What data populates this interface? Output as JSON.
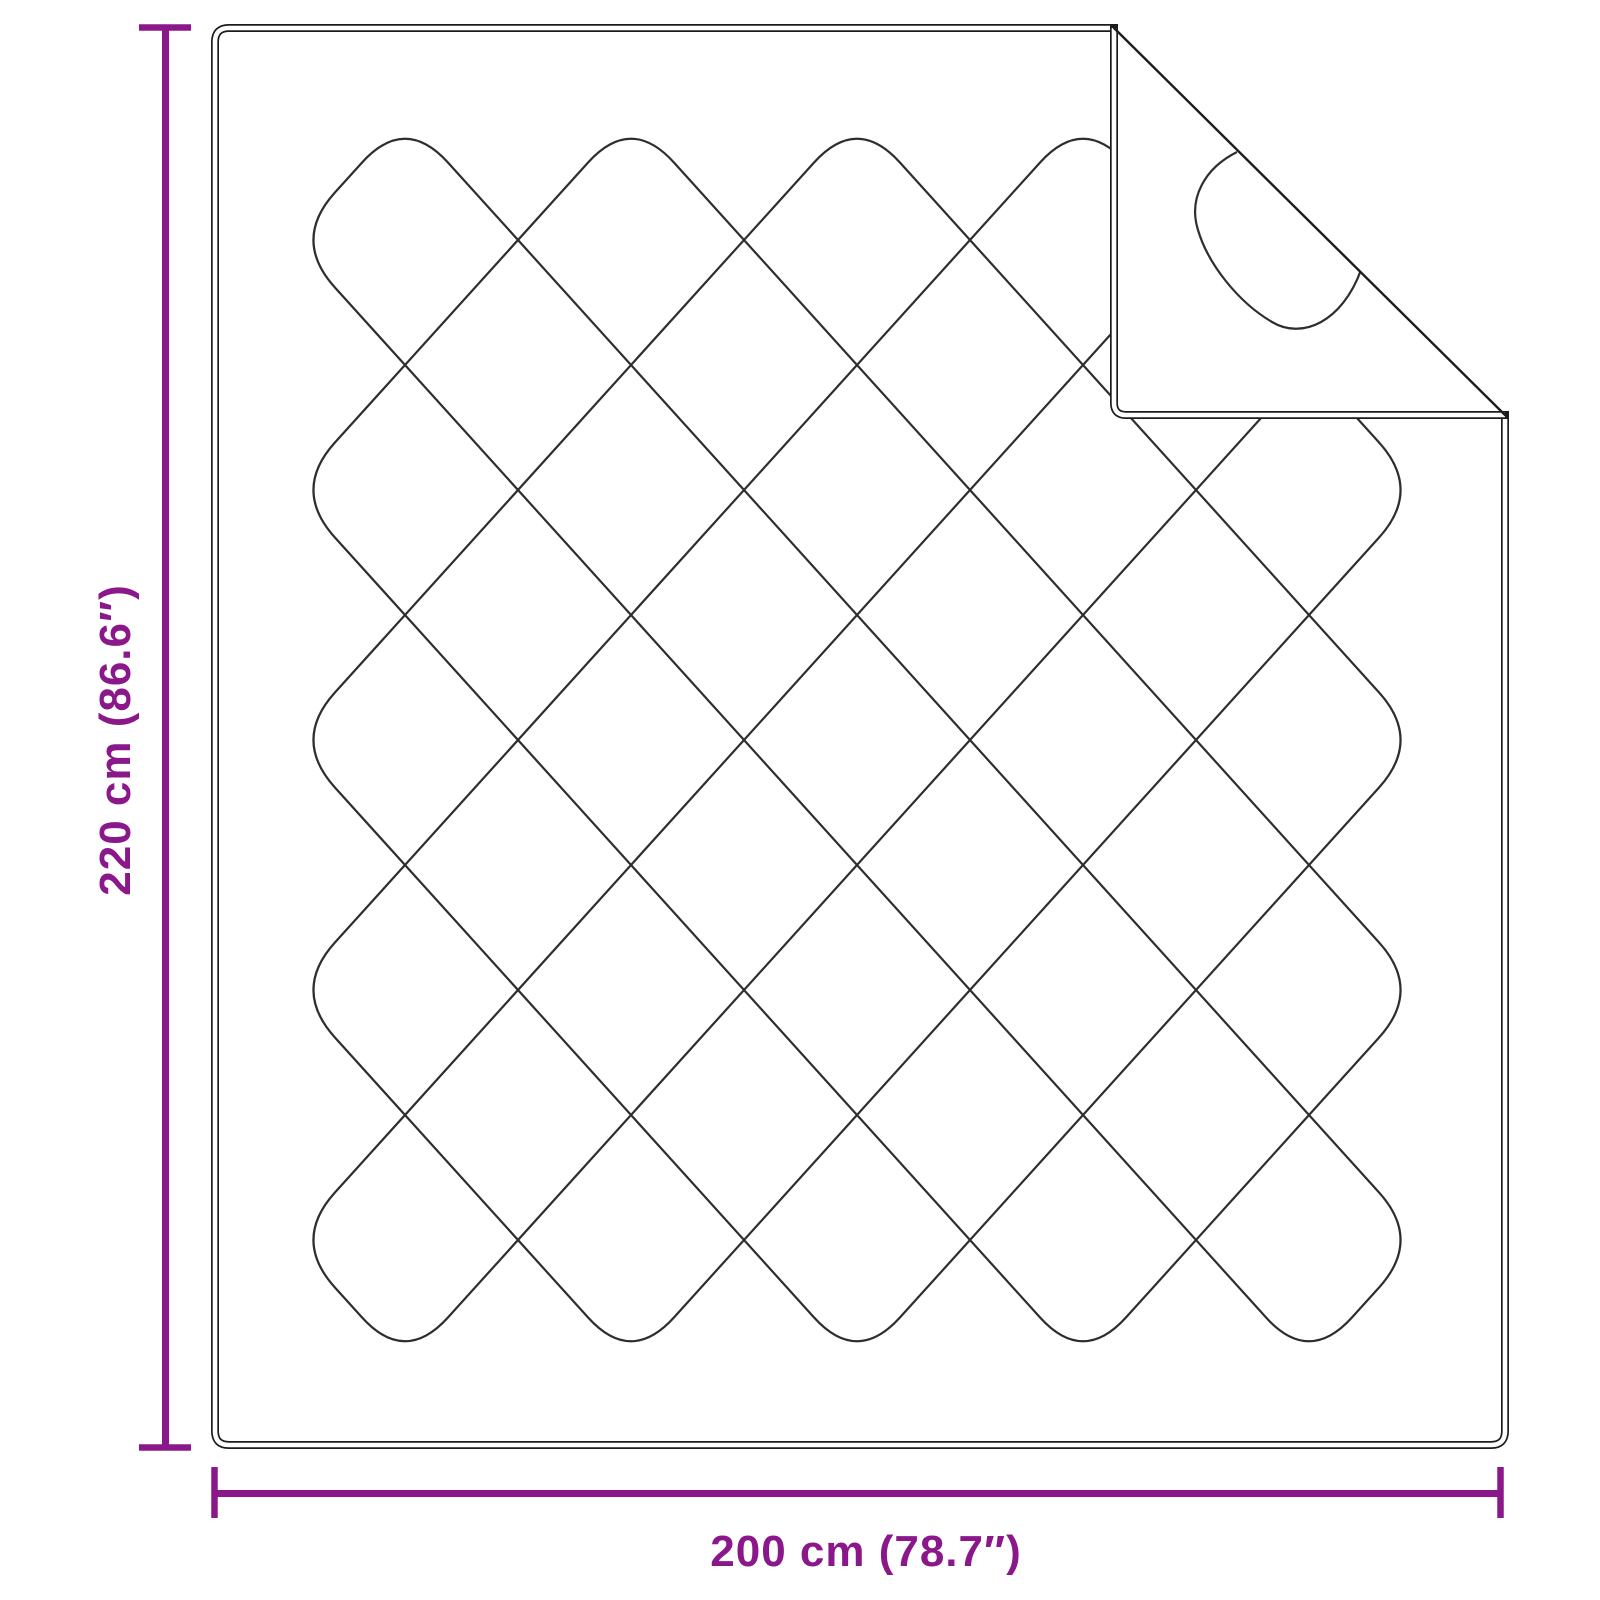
{
  "labels": {
    "height": "220 cm (86.6″)",
    "width": "200 cm (78.7″)"
  },
  "colors": {
    "accent": "#8B188B",
    "outline": "#1c1c1c",
    "stitch": "#2e2e2e",
    "background": "#ffffff"
  }
}
